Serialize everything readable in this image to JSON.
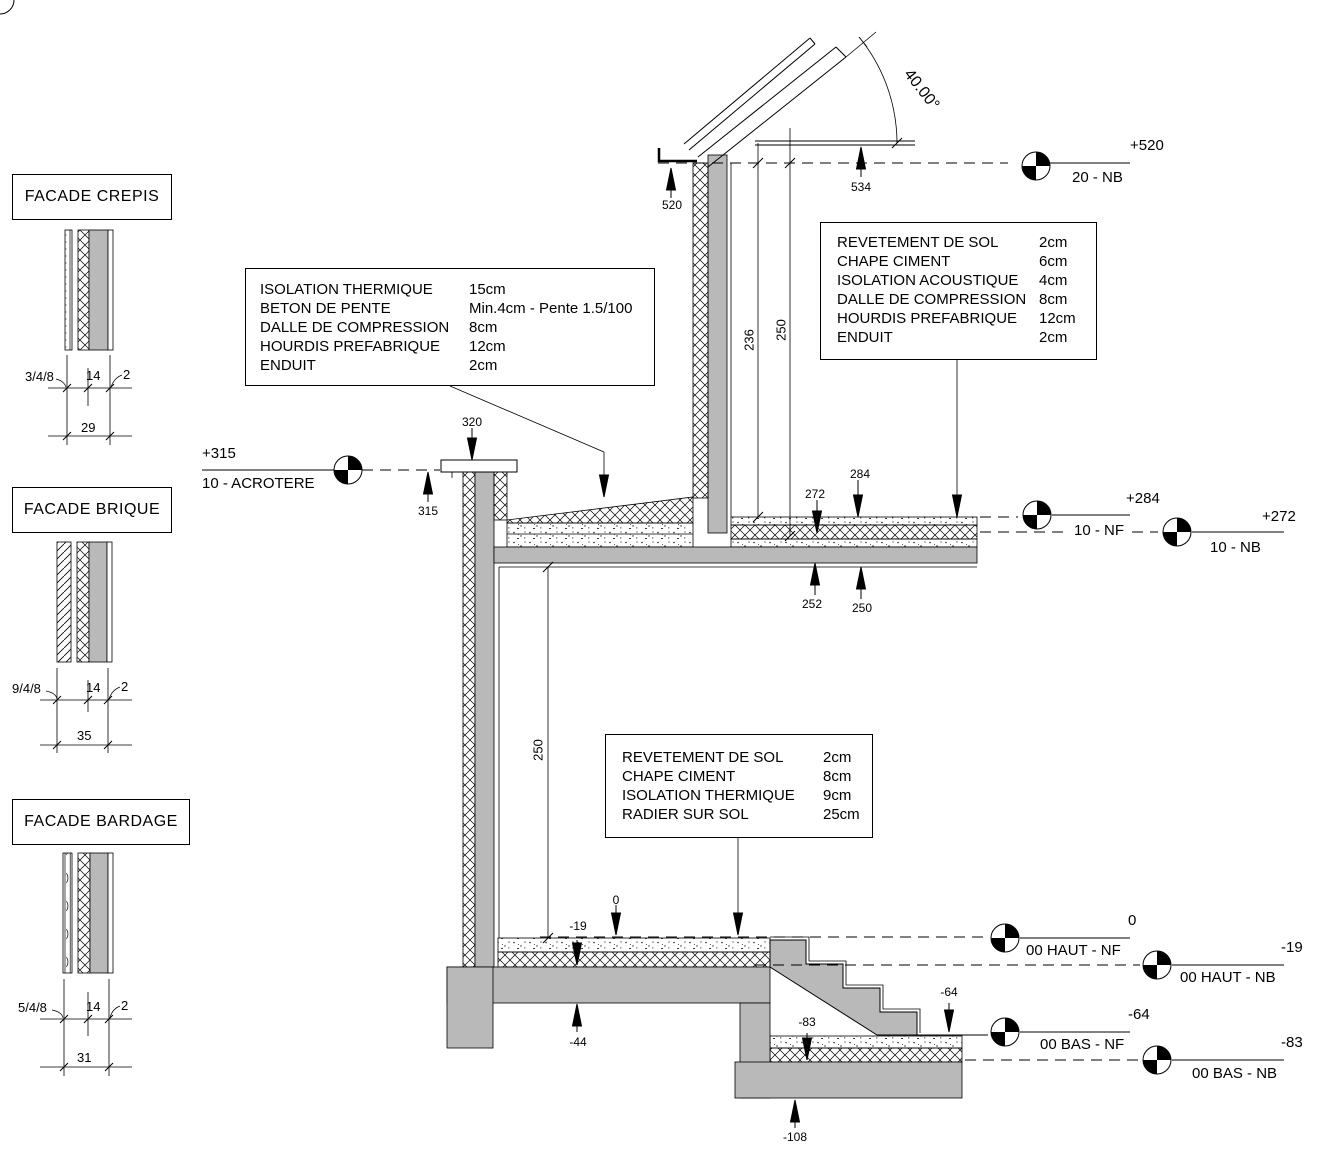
{
  "drawing_title": "Coupe de detail - facades et niveaux",
  "colors": {
    "concrete": "#b9b9b9",
    "line": "#000000",
    "paper": "#ffffff"
  },
  "facades": [
    {
      "title": "FACADE CREPIS",
      "d1": "3/4/8",
      "d2": "14",
      "d3": "2",
      "total": "29"
    },
    {
      "title": "FACADE BRIQUE",
      "d1": "9/4/8",
      "d2": "14",
      "d3": "2",
      "total": "35"
    },
    {
      "title": "FACADE BARDAGE",
      "d1": "5/4/8",
      "d2": "14",
      "d3": "2",
      "total": "31"
    }
  ],
  "boxes": {
    "roof": {
      "rows": [
        [
          "ISOLATION THERMIQUE",
          "15cm"
        ],
        [
          "BETON DE PENTE",
          "Min.4cm - Pente 1.5/100"
        ],
        [
          "DALLE DE COMPRESSION",
          "8cm"
        ],
        [
          "HOURDIS PREFABRIQUE",
          "12cm"
        ],
        [
          "ENDUIT",
          "2cm"
        ]
      ]
    },
    "floor": {
      "rows": [
        [
          "REVETEMENT DE SOL",
          "2cm"
        ],
        [
          "CHAPE CIMENT",
          "6cm"
        ],
        [
          "ISOLATION ACOUSTIQUE",
          "4cm"
        ],
        [
          "DALLE DE COMPRESSION",
          "8cm"
        ],
        [
          "HOURDIS PREFABRIQUE",
          "12cm"
        ],
        [
          "ENDUIT",
          "2cm"
        ]
      ]
    },
    "ground": {
      "rows": [
        [
          "REVETEMENT DE SOL",
          "2cm"
        ],
        [
          "CHAPE CIMENT",
          "8cm"
        ],
        [
          "ISOLATION THERMIQUE",
          "9cm"
        ],
        [
          "RADIER SUR SOL",
          "25cm"
        ]
      ]
    }
  },
  "levels": {
    "l520": {
      "value": "+520",
      "name": "20 - NB"
    },
    "l315": {
      "value": "+315",
      "name": "10 - ACROTERE"
    },
    "l284": {
      "value": "+284",
      "name": "10 - NF"
    },
    "l272": {
      "value": "+272",
      "name": "10 - NB"
    },
    "l0": {
      "value": "0",
      "name": "00 HAUT - NF"
    },
    "lm19": {
      "value": "-19",
      "name": "00 HAUT - NB"
    },
    "lm64": {
      "value": "-64",
      "name": "00 BAS - NF"
    },
    "lm83": {
      "value": "-83",
      "name": "00 BAS - NB"
    }
  },
  "marks": {
    "m520": "520",
    "m534": "534",
    "m320": "320",
    "m315": "315",
    "m284": "284",
    "m272": "272",
    "m252": "252",
    "m250u": "250",
    "h236": "236",
    "h250a": "250",
    "h250b": "250",
    "m0": "0",
    "m19": "-19",
    "m44": "-44",
    "m64": "-64",
    "m83": "-83",
    "m108": "-108"
  },
  "angle": {
    "label": "40.00°"
  }
}
